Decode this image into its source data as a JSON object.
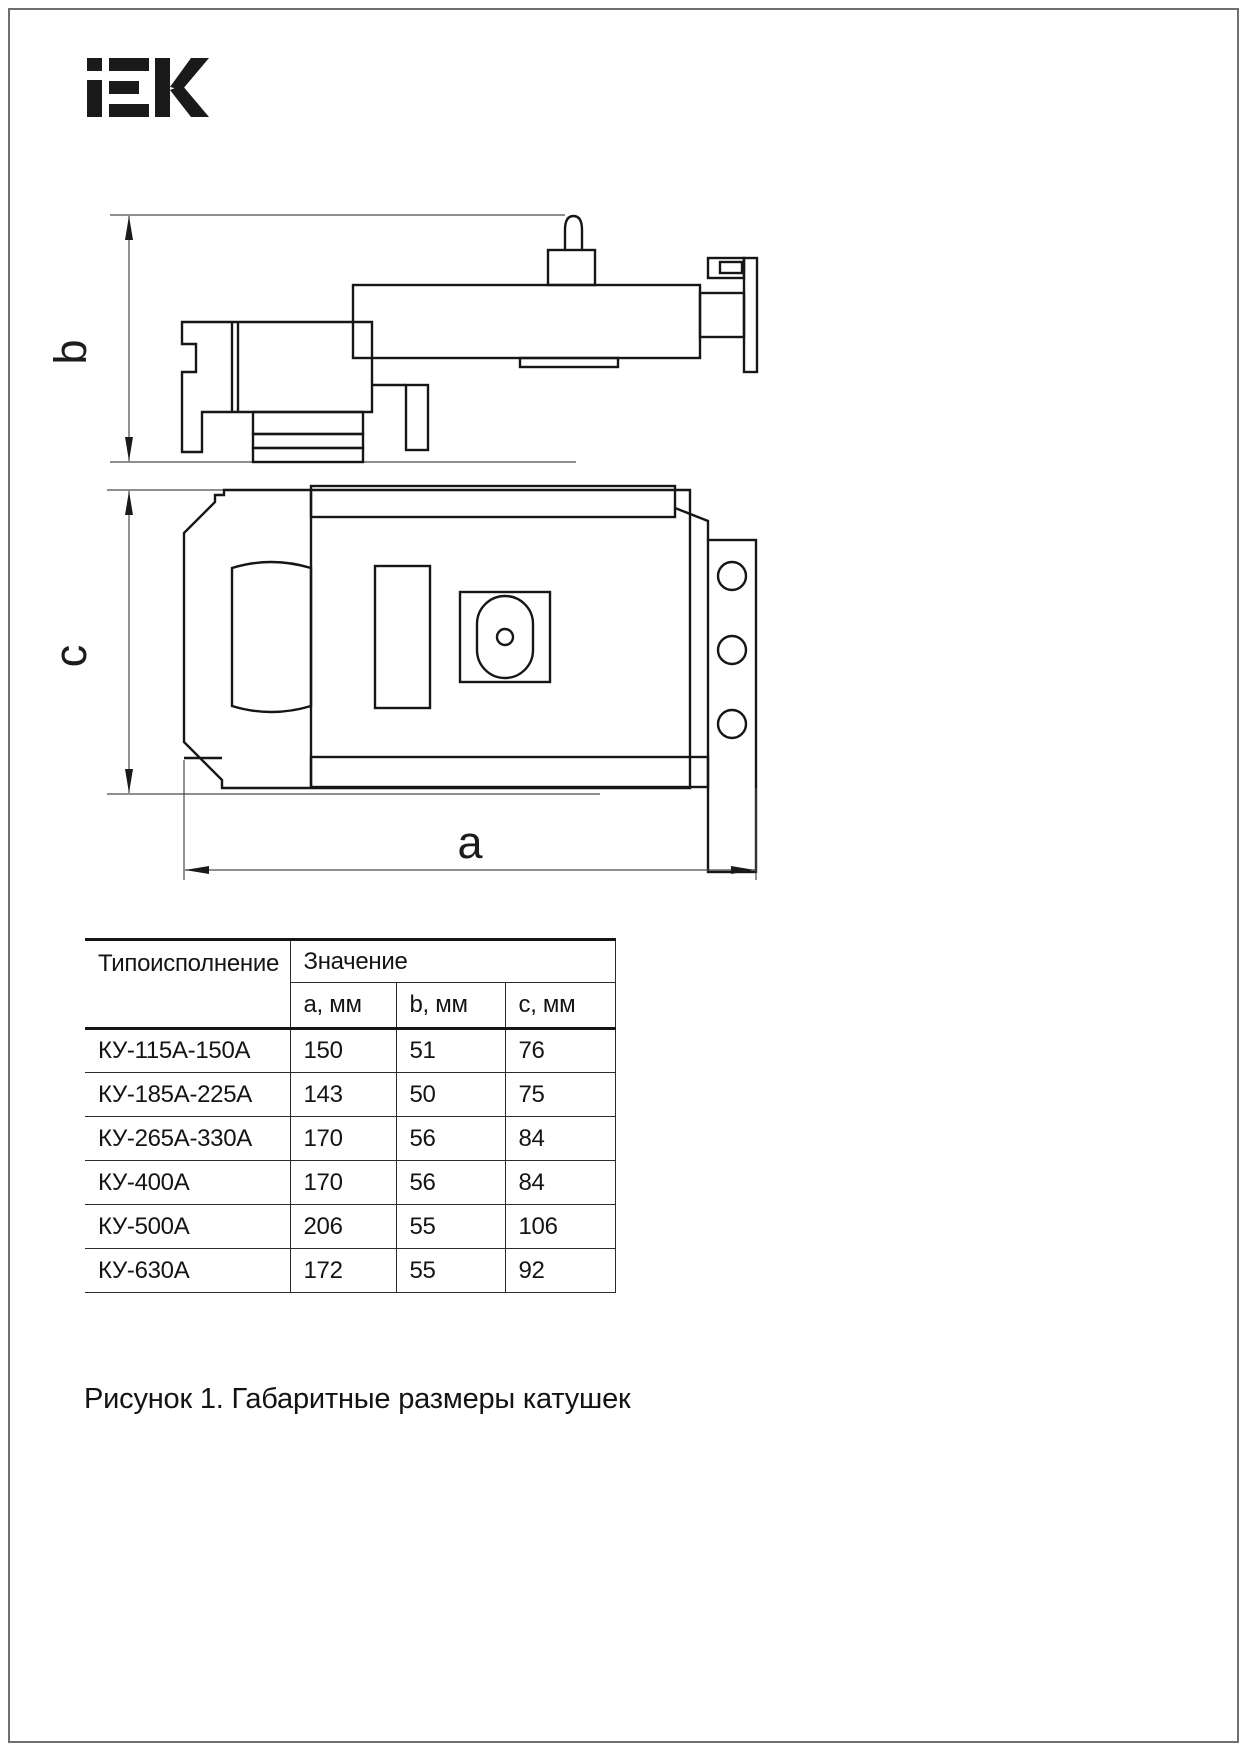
{
  "brand": {
    "logo": "IEK"
  },
  "drawing": {
    "dim_b": "b",
    "dim_c": "c",
    "dim_a": "a"
  },
  "table": {
    "headers": {
      "type": "Типоисполнение",
      "value": "Значение",
      "sub": [
        "a, мм",
        "b, мм",
        "c, мм"
      ]
    },
    "rows": [
      {
        "type": "КУ-115А-150А",
        "a": "150",
        "b": "51",
        "c": "76"
      },
      {
        "type": "КУ-185А-225А",
        "a": "143",
        "b": "50",
        "c": "75"
      },
      {
        "type": "КУ-265А-330А",
        "a": "170",
        "b": "56",
        "c": "84"
      },
      {
        "type": "КУ-400А",
        "a": "170",
        "b": "56",
        "c": "84"
      },
      {
        "type": "КУ-500А",
        "a": "206",
        "b": "55",
        "c": "106"
      },
      {
        "type": "КУ-630А",
        "a": "172",
        "b": "55",
        "c": "92"
      }
    ]
  },
  "caption": "Рисунок 1. Габаритные размеры катушек"
}
